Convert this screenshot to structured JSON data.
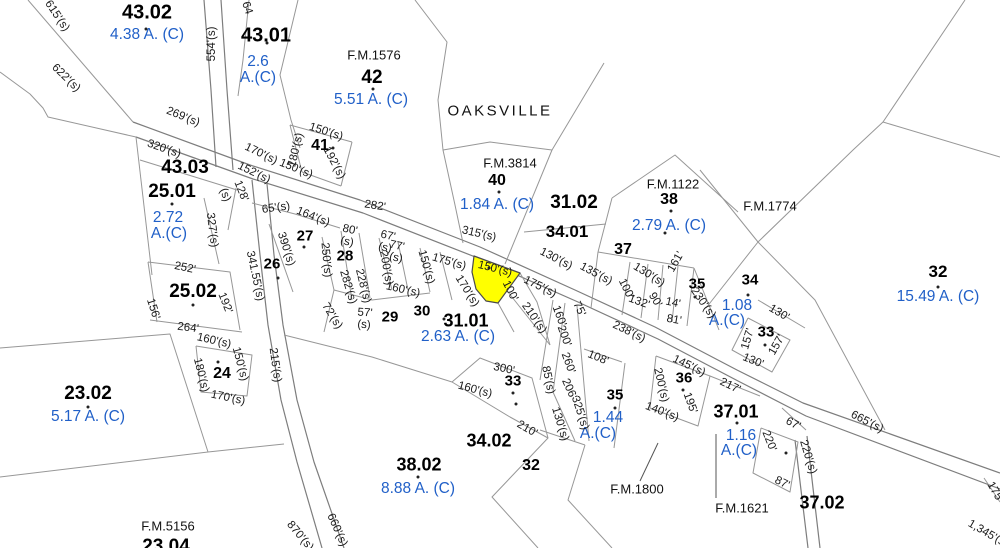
{
  "map": {
    "place": {
      "text": "OAKSVILLE",
      "x": 500,
      "y": 111
    },
    "colors": {
      "acreage_blue": "#2160c8",
      "highlight_yellow": "#ffff00",
      "line_gray": "#979797",
      "road_gray": "#7d7d7d",
      "text_black": "#000000"
    },
    "highlight": {
      "polygon": "474,256 520,273 498,303 486,301 476,289 472,272",
      "label": "150'(s)"
    },
    "parcels": [
      {
        "t": "43.02",
        "x": 147,
        "y": 13,
        "s": 20
      },
      {
        "t": "43.01",
        "x": 266,
        "y": 36,
        "s": 20
      },
      {
        "t": "42",
        "x": 372,
        "y": 78,
        "s": 19
      },
      {
        "t": "41",
        "x": 320,
        "y": 146,
        "s": 16
      },
      {
        "t": "40",
        "x": 497,
        "y": 181,
        "s": 16
      },
      {
        "t": "43.03",
        "x": 185,
        "y": 168,
        "s": 19
      },
      {
        "t": "25.01",
        "x": 172,
        "y": 192,
        "s": 19
      },
      {
        "t": "31.02",
        "x": 574,
        "y": 203,
        "s": 19
      },
      {
        "t": "38",
        "x": 669,
        "y": 200,
        "s": 16
      },
      {
        "t": "34.01",
        "x": 567,
        "y": 232,
        "s": 17
      },
      {
        "t": "37",
        "x": 623,
        "y": 250,
        "s": 16
      },
      {
        "t": "27",
        "x": 305,
        "y": 236,
        "s": 15
      },
      {
        "t": "28",
        "x": 345,
        "y": 256,
        "s": 15
      },
      {
        "t": "26",
        "x": 272,
        "y": 264,
        "s": 15
      },
      {
        "t": "25.02",
        "x": 193,
        "y": 292,
        "s": 19
      },
      {
        "t": "35",
        "x": 697,
        "y": 284,
        "s": 15
      },
      {
        "t": "34",
        "x": 750,
        "y": 280,
        "s": 15
      },
      {
        "t": "32",
        "x": 938,
        "y": 272,
        "s": 17
      },
      {
        "t": "29",
        "x": 390,
        "y": 317,
        "s": 15
      },
      {
        "t": "30",
        "x": 422,
        "y": 311,
        "s": 15
      },
      {
        "t": "31.01",
        "x": 466,
        "y": 321,
        "s": 18
      },
      {
        "t": "33",
        "x": 766,
        "y": 332,
        "s": 15
      },
      {
        "t": "24",
        "x": 222,
        "y": 374,
        "s": 16
      },
      {
        "t": "33",
        "x": 513,
        "y": 381,
        "s": 15
      },
      {
        "t": "36",
        "x": 684,
        "y": 378,
        "s": 15
      },
      {
        "t": "35",
        "x": 615,
        "y": 395,
        "s": 15
      },
      {
        "t": "23.02",
        "x": 88,
        "y": 394,
        "s": 19
      },
      {
        "t": "37.01",
        "x": 736,
        "y": 412,
        "s": 18
      },
      {
        "t": "34.02",
        "x": 489,
        "y": 441,
        "s": 18
      },
      {
        "t": "32",
        "x": 531,
        "y": 466,
        "s": 16
      },
      {
        "t": "38.02",
        "x": 419,
        "y": 465,
        "s": 18
      },
      {
        "t": "37.02",
        "x": 822,
        "y": 503,
        "s": 18
      },
      {
        "t": "23.04",
        "x": 166,
        "y": 547,
        "s": 19
      }
    ],
    "acreages": [
      {
        "t": "4.38 A. (C)",
        "x": 147,
        "y": 35
      },
      {
        "t": "2.6",
        "x": 258,
        "y": 62
      },
      {
        "t": "A.(C)",
        "x": 258,
        "y": 78
      },
      {
        "t": "5.51 A. (C)",
        "x": 371,
        "y": 100
      },
      {
        "t": "1.84 A. (C)",
        "x": 497,
        "y": 205
      },
      {
        "t": "2.79 A. (C)",
        "x": 669,
        "y": 226
      },
      {
        "t": "2.72",
        "x": 168,
        "y": 218
      },
      {
        "t": "A.(C)",
        "x": 169,
        "y": 234
      },
      {
        "t": "15.49 A. (C)",
        "x": 938,
        "y": 297
      },
      {
        "t": "2.63 A. (C)",
        "x": 458,
        "y": 337
      },
      {
        "t": "1.08",
        "x": 737,
        "y": 306
      },
      {
        "t": "A.(C)",
        "x": 727,
        "y": 321
      },
      {
        "t": "1.44",
        "x": 608,
        "y": 418
      },
      {
        "t": "A.(C)",
        "x": 598,
        "y": 434
      },
      {
        "t": "1.16",
        "x": 741,
        "y": 436
      },
      {
        "t": "A.(C)",
        "x": 739,
        "y": 451
      },
      {
        "t": "5.17 A. (C)",
        "x": 88,
        "y": 417
      },
      {
        "t": "8.88 A. (C)",
        "x": 418,
        "y": 489
      }
    ],
    "fm_labels": [
      {
        "t": "F.M.1576",
        "x": 374,
        "y": 55
      },
      {
        "t": "F.M.3814",
        "x": 510,
        "y": 163
      },
      {
        "t": "F.M.1122",
        "x": 673,
        "y": 184
      },
      {
        "t": "F.M.1774",
        "x": 770,
        "y": 206
      },
      {
        "t": "F.M.1800",
        "x": 637,
        "y": 489
      },
      {
        "t": "F.M.1621",
        "x": 742,
        "y": 508
      },
      {
        "t": "F.M.5156",
        "x": 168,
        "y": 526
      }
    ],
    "dimensions": [
      {
        "t": "615'(s)",
        "x": 57,
        "y": 16,
        "r": 56
      },
      {
        "t": "622'(s)",
        "x": 66,
        "y": 78,
        "r": 44
      },
      {
        "t": "554'(s)",
        "x": 212,
        "y": 44,
        "r": -90
      },
      {
        "t": "64",
        "x": 247,
        "y": 8,
        "r": 72
      },
      {
        "t": "269'(s)",
        "x": 183,
        "y": 117,
        "r": 22
      },
      {
        "t": "320'(s)",
        "x": 164,
        "y": 149,
        "r": 19
      },
      {
        "t": "170'(s)",
        "x": 261,
        "y": 154,
        "r": 26
      },
      {
        "t": "152'(s)",
        "x": 254,
        "y": 173,
        "r": 26
      },
      {
        "t": "150'(s)",
        "x": 296,
        "y": 169,
        "r": 22
      },
      {
        "t": "150'(s)",
        "x": 326,
        "y": 132,
        "r": 18
      },
      {
        "t": "180'(s)",
        "x": 296,
        "y": 150,
        "r": -77
      },
      {
        "t": "192'(s)",
        "x": 334,
        "y": 163,
        "r": 62
      },
      {
        "t": "128'",
        "x": 241,
        "y": 191,
        "r": 68
      },
      {
        "t": "(s)",
        "x": 225,
        "y": 195,
        "r": 68
      },
      {
        "t": "327'(s)",
        "x": 212,
        "y": 230,
        "r": 83
      },
      {
        "t": "341.55'(s)",
        "x": 255,
        "y": 276,
        "r": 78
      },
      {
        "t": "65'(s)",
        "x": 276,
        "y": 208,
        "r": -8
      },
      {
        "t": "164'(s)",
        "x": 313,
        "y": 217,
        "r": 22
      },
      {
        "t": "282'",
        "x": 375,
        "y": 206,
        "r": 9
      },
      {
        "t": "390'(s)",
        "x": 286,
        "y": 249,
        "r": 72
      },
      {
        "t": "250'(s)",
        "x": 326,
        "y": 260,
        "r": 85
      },
      {
        "t": "80'",
        "x": 350,
        "y": 230,
        "r": 12
      },
      {
        "t": "(s)",
        "x": 347,
        "y": 242,
        "r": 12
      },
      {
        "t": "67'",
        "x": 388,
        "y": 236,
        "r": 12
      },
      {
        "t": "(s)",
        "x": 385,
        "y": 248,
        "r": 12
      },
      {
        "t": "77'",
        "x": 397,
        "y": 246,
        "r": 12
      },
      {
        "t": "(s)",
        "x": 396,
        "y": 258,
        "r": 12
      },
      {
        "t": "57'",
        "x": 365,
        "y": 313,
        "r": 4
      },
      {
        "t": "(s)",
        "x": 364,
        "y": 325,
        "r": 4
      },
      {
        "t": "72'(s)",
        "x": 332,
        "y": 316,
        "r": 58
      },
      {
        "t": "282'(s)",
        "x": 348,
        "y": 287,
        "r": 73
      },
      {
        "t": "228'(s)",
        "x": 363,
        "y": 286,
        "r": 76
      },
      {
        "t": "200'(s)",
        "x": 386,
        "y": 268,
        "r": 80
      },
      {
        "t": "160'(s)",
        "x": 403,
        "y": 290,
        "r": 13
      },
      {
        "t": "150'(s)",
        "x": 426,
        "y": 267,
        "r": 74
      },
      {
        "t": "175'(s)",
        "x": 449,
        "y": 262,
        "r": 16
      },
      {
        "t": "315'(s)",
        "x": 479,
        "y": 234,
        "r": 13
      },
      {
        "t": "150'(s)",
        "x": 495,
        "y": 269,
        "r": 14
      },
      {
        "t": "170'(s)",
        "x": 467,
        "y": 291,
        "r": 58
      },
      {
        "t": "100'",
        "x": 510,
        "y": 291,
        "r": 63
      },
      {
        "t": "175'(s)",
        "x": 540,
        "y": 287,
        "r": 26
      },
      {
        "t": "210'(s)",
        "x": 534,
        "y": 318,
        "r": 55
      },
      {
        "t": "160'",
        "x": 559,
        "y": 316,
        "r": 70
      },
      {
        "t": "200'",
        "x": 564,
        "y": 336,
        "r": 70
      },
      {
        "t": "260'",
        "x": 568,
        "y": 363,
        "r": 70
      },
      {
        "t": "85'(s)",
        "x": 548,
        "y": 380,
        "r": 78
      },
      {
        "t": "206'",
        "x": 569,
        "y": 389,
        "r": 66
      },
      {
        "t": "325'(s)",
        "x": 580,
        "y": 413,
        "r": 72
      },
      {
        "t": "130'(s)",
        "x": 560,
        "y": 424,
        "r": 73
      },
      {
        "t": "108'",
        "x": 598,
        "y": 358,
        "r": 22
      },
      {
        "t": "238'(s)",
        "x": 629,
        "y": 332,
        "r": 26
      },
      {
        "t": "75'",
        "x": 579,
        "y": 309,
        "r": 64
      },
      {
        "t": "130'(s)",
        "x": 556,
        "y": 259,
        "r": 27
      },
      {
        "t": "135'(s)",
        "x": 596,
        "y": 274,
        "r": 28
      },
      {
        "t": "130'(s)",
        "x": 649,
        "y": 275,
        "r": 32
      },
      {
        "t": "161'",
        "x": 676,
        "y": 262,
        "r": -60
      },
      {
        "t": "100'",
        "x": 626,
        "y": 289,
        "r": 64
      },
      {
        "t": "132'",
        "x": 639,
        "y": 302,
        "r": 20
      },
      {
        "t": "90'",
        "x": 655,
        "y": 300,
        "r": 58
      },
      {
        "t": "14'",
        "x": 673,
        "y": 303,
        "r": 12
      },
      {
        "t": "81'",
        "x": 674,
        "y": 320,
        "r": 10
      },
      {
        "t": "230'(s)",
        "x": 703,
        "y": 303,
        "r": 55
      },
      {
        "t": "130'",
        "x": 779,
        "y": 313,
        "r": 31
      },
      {
        "t": "157'",
        "x": 748,
        "y": 339,
        "r": -74
      },
      {
        "t": "157'",
        "x": 777,
        "y": 345,
        "r": -60
      },
      {
        "t": "130'",
        "x": 753,
        "y": 361,
        "r": 22
      },
      {
        "t": "145'(s)",
        "x": 689,
        "y": 366,
        "r": 26
      },
      {
        "t": "200'(s)",
        "x": 661,
        "y": 385,
        "r": 77
      },
      {
        "t": "140'(s)",
        "x": 662,
        "y": 412,
        "r": 21
      },
      {
        "t": "195'",
        "x": 690,
        "y": 403,
        "r": 70
      },
      {
        "t": "217'",
        "x": 730,
        "y": 386,
        "r": 26
      },
      {
        "t": "67'",
        "x": 793,
        "y": 424,
        "r": 28
      },
      {
        "t": "220'",
        "x": 769,
        "y": 441,
        "r": 68
      },
      {
        "t": "220'(s)",
        "x": 808,
        "y": 457,
        "r": 73
      },
      {
        "t": "87'",
        "x": 782,
        "y": 483,
        "r": 26
      },
      {
        "t": "665'(s)",
        "x": 867,
        "y": 422,
        "r": 27
      },
      {
        "t": "1,345'(s)",
        "x": 988,
        "y": 534,
        "r": 30
      },
      {
        "t": "175'",
        "x": 995,
        "y": 492,
        "r": 60
      },
      {
        "t": "252'",
        "x": 185,
        "y": 268,
        "r": 12
      },
      {
        "t": "156'",
        "x": 153,
        "y": 309,
        "r": 72
      },
      {
        "t": "192'",
        "x": 225,
        "y": 303,
        "r": 68
      },
      {
        "t": "264'",
        "x": 188,
        "y": 328,
        "r": 7
      },
      {
        "t": "160'(s)",
        "x": 214,
        "y": 341,
        "r": 13
      },
      {
        "t": "150'(s)",
        "x": 240,
        "y": 364,
        "r": 75
      },
      {
        "t": "180'(s)",
        "x": 201,
        "y": 375,
        "r": 76
      },
      {
        "t": "170'(s)",
        "x": 228,
        "y": 398,
        "r": 12
      },
      {
        "t": "215'(s)",
        "x": 275,
        "y": 365,
        "r": 82
      },
      {
        "t": "300'",
        "x": 504,
        "y": 369,
        "r": 12
      },
      {
        "t": "160'(s)",
        "x": 475,
        "y": 390,
        "r": 15
      },
      {
        "t": "210'",
        "x": 527,
        "y": 429,
        "r": 30
      },
      {
        "t": "660'(s)",
        "x": 337,
        "y": 530,
        "r": 66
      },
      {
        "t": "870'(s)",
        "x": 300,
        "y": 536,
        "r": 50
      }
    ],
    "dots": [
      [
        146,
        29
      ],
      [
        267,
        43
      ],
      [
        373,
        89
      ],
      [
        333,
        148
      ],
      [
        499,
        192
      ],
      [
        671,
        211
      ],
      [
        665,
        233
      ],
      [
        172,
        204
      ],
      [
        193,
        305
      ],
      [
        278,
        278
      ],
      [
        304,
        247
      ],
      [
        444,
        319
      ],
      [
        513,
        393
      ],
      [
        516,
        404
      ],
      [
        615,
        408
      ],
      [
        683,
        390
      ],
      [
        748,
        295
      ],
      [
        695,
        297
      ],
      [
        765,
        345
      ],
      [
        938,
        287
      ],
      [
        88,
        407
      ],
      [
        218,
        362
      ],
      [
        737,
        423
      ],
      [
        786,
        453
      ],
      [
        418,
        477
      ],
      [
        489,
        268
      ]
    ],
    "lines": {
      "roads": [
        "133,122 250,165 360,200 480,247 575,290 655,327 737,370 803,403 1000,473",
        "136,137 253,179 363,213 483,260 578,302 658,339 740,382 806,416 1000,489",
        "204,0 211,90 216,167",
        "221,0 227,90 233,170",
        "252,180 260,255 268,325 281,400 297,462 322,548",
        "267,184 274,255 283,325 297,400 314,462 344,548",
        "795,440 801,490 808,548",
        "807,436 813,488 820,548"
      ],
      "boundaries": [
        "28,0 133,122",
        "0,72 30,94 43,108 48,117 136,137",
        "249,0 243,60 238,96",
        "298,0 280,75 291,120 300,148",
        "415,0 447,42 438,100 443,150 455,205 463,243",
        "290,125 352,142",
        "290,125 302,172",
        "352,142 341,186",
        "302,172 341,186",
        "443,150 490,142 552,150",
        "604,63 552,150 505,264",
        "612,198 675,155 738,212",
        "612,198 598,252",
        "598,252 694,268",
        "598,252 591,308",
        "630,262 622,315",
        "648,264 641,318",
        "663,265 658,320",
        "678,266 672,322",
        "694,268 687,326",
        "700,170 758,242 815,300 885,430",
        "965,0 883,122 853,150 758,242 706,308",
        "883,122 1000,157",
        "694,268 719,330",
        "748,318 790,340 772,372 732,350 748,318",
        "758,300 805,328",
        "656,356 710,376 698,426 650,408 656,356",
        "710,376 760,396",
        "782,408 806,430",
        "761,428 798,442 790,492 753,473 761,428",
        "584,349 622,362",
        "553,300 540,380",
        "565,303 553,392 575,441",
        "577,306 589,441",
        "540,430 585,445",
        "625,363 614,448",
        "452,382 480,358 532,378 548,438 510,417 452,382",
        "548,438 492,497 538,548",
        "585,445 568,500 612,548",
        "0,348 170,334 208,452",
        "0,477 208,452 284,444",
        "148,262 230,272 240,330",
        "148,262 157,322",
        "150,320 242,332",
        "196,346 252,355 247,396 201,392 196,346",
        "136,137 152,275",
        "140,160 237,190",
        "204,198 219,264",
        "236,188 228,230",
        "252,203 295,214 340,228",
        "269,224 293,292",
        "322,237 334,290",
        "341,231 352,300",
        "359,233 370,298",
        "379,238 392,290",
        "398,242 408,290",
        "420,248 430,292",
        "334,290 372,300 430,293",
        "440,252 452,300",
        "334,290 324,332",
        "508,292 550,345",
        "498,303 514,332",
        "520,273 537,302 550,345",
        "524,232 606,224",
        "284,335 372,357 452,382",
        "984,478 1000,502"
      ],
      "leaders": [
        "640,481 658,443",
        "716,434 716,498"
      ]
    }
  }
}
